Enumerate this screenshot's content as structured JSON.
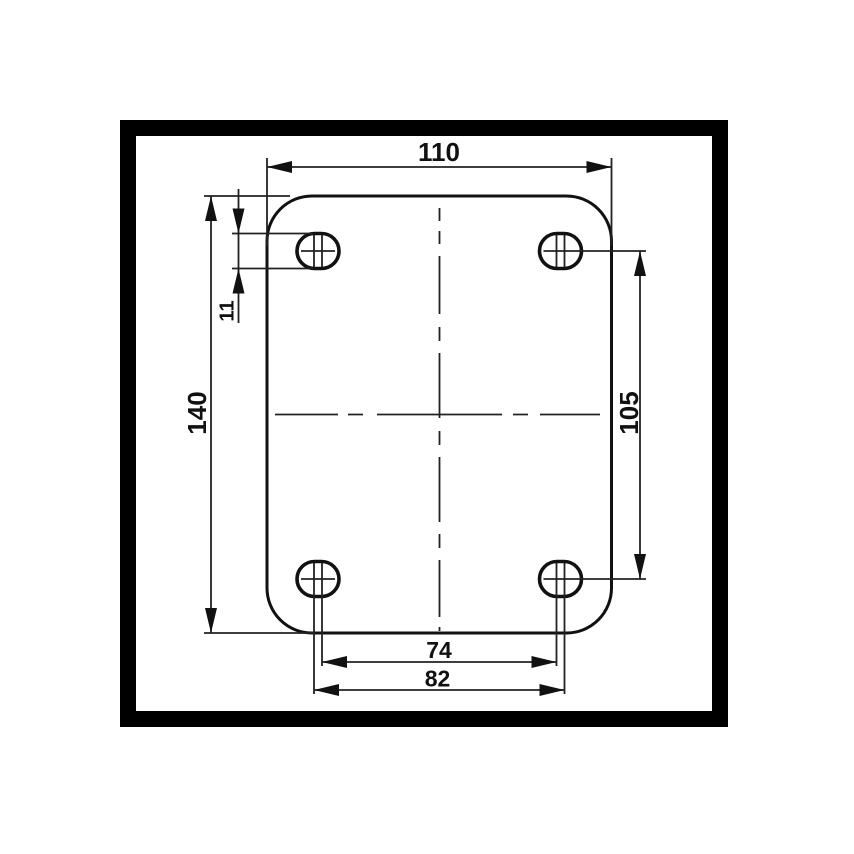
{
  "drawing": {
    "type": "technical-dimension-drawing",
    "subject": "plate with four slotted mounting holes, top view",
    "labels": {
      "plate_width": "110",
      "plate_height": "140",
      "hole_size": "11",
      "hole_spacing_vertical": "105",
      "hole_spacing_inner": "74",
      "hole_spacing_outer": "82"
    },
    "colors": {
      "background": "#ffffff",
      "frame": "#000000",
      "line": "#111111"
    }
  }
}
